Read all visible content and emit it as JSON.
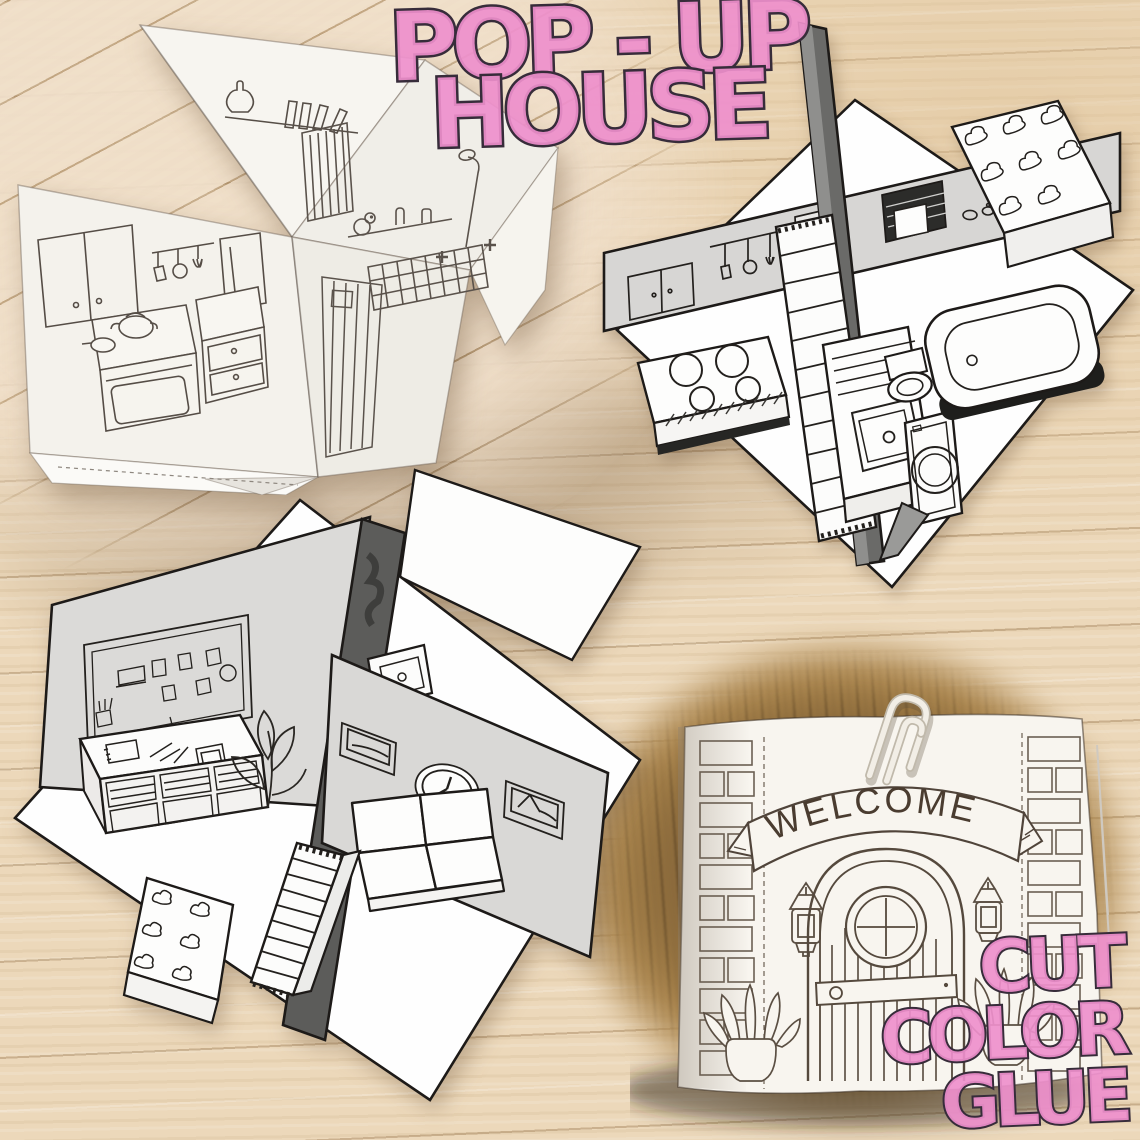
{
  "overlay": {
    "title": {
      "line1": "POP - UP",
      "line2": "HOUSE"
    },
    "cta": {
      "line1": "CUT",
      "line2": "COLOR",
      "line3": "GLUE"
    }
  },
  "closed_house": {
    "banner_text": "WELCOME"
  },
  "colors": {
    "bubble_pink": "#ee8fcc",
    "bubble_outline": "#372c3a",
    "wood_light": "#ecd8ba",
    "wood_dark_patch": "#7b5c36",
    "paper_white": "#f7f4ee",
    "render_wall_gray": "#d8d7d5",
    "render_dark_wall": "#5c5c5a",
    "line_art_ink": "#241f1b"
  },
  "scenes": {
    "top_left_photo": "folded paper pop-up house photo with kitchen and bathroom coloring art",
    "top_right_render": "pop-up house render with staircase, cloud bed, stove, sink, washing machine, toilet and bathtub",
    "bottom_left_render": "pop-up house render with pinboard desk, plant wall, clock, frames, sofa, staircase and cloud bed",
    "bottom_right_photo": "closed pop-up house cover with brick columns, welcome banner, lanterns, arched door, potted plants and paperclip"
  }
}
